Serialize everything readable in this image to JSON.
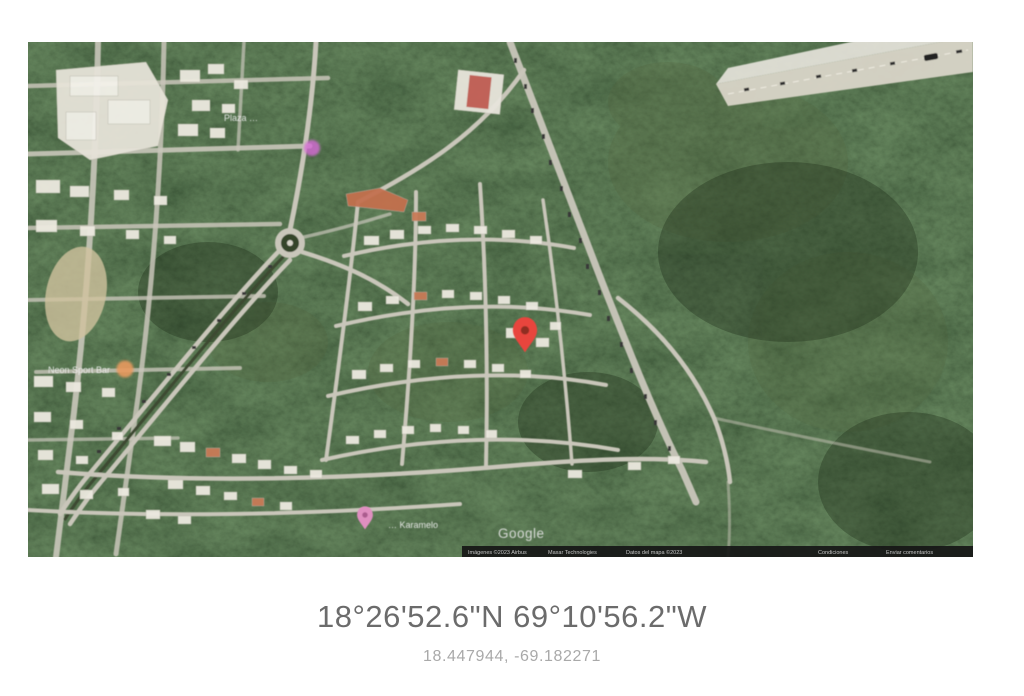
{
  "colors": {
    "page_bg": "#ffffff",
    "forest_green": "#2d3b27",
    "road_light": "#c9c6ba",
    "building_white": "#ece9e0",
    "roof_orange": "#c3704f",
    "bare_field": "#cfc29e",
    "pin_red": "#e8453c",
    "marker_pink": "#d66ad6",
    "pin_pink": "#df8fc0",
    "marker_orange": "#e89a5f",
    "attribution_bg": "#161616",
    "dms_text": "#6b6b6b",
    "decimal_text": "#a9a9a9"
  },
  "map": {
    "type": "satellite",
    "watermark": "Google",
    "labels": [
      {
        "text": "Plaza …",
        "x": 196,
        "y": 79
      },
      {
        "text": "Neon Sport Bar",
        "x": 20,
        "y": 331
      },
      {
        "text": "… Karamelo",
        "x": 360,
        "y": 486
      }
    ],
    "markers": [
      {
        "name": "destination-pin",
        "shape": "teardrop",
        "color": "#e8453c",
        "x": 497,
        "y": 296
      },
      {
        "name": "plaza-dot",
        "shape": "circle",
        "color": "#d66ad6",
        "x": 284,
        "y": 106
      },
      {
        "name": "sport-bar-dot",
        "shape": "circle",
        "color": "#e89a5f",
        "x": 97,
        "y": 327
      },
      {
        "name": "karamelo-pin",
        "shape": "teardrop",
        "color": "#df8fc0",
        "x": 337,
        "y": 478
      }
    ],
    "attribution_segments": [
      "Imágenes ©2023 Airbus",
      "Maxar Technologies",
      "Datos del mapa ©2023",
      "Condiciones",
      "Enviar comentarios"
    ]
  },
  "coordinates": {
    "dms": "18°26'52.6\"N 69°10'56.2\"W",
    "decimal": "18.447944, -69.182271"
  }
}
